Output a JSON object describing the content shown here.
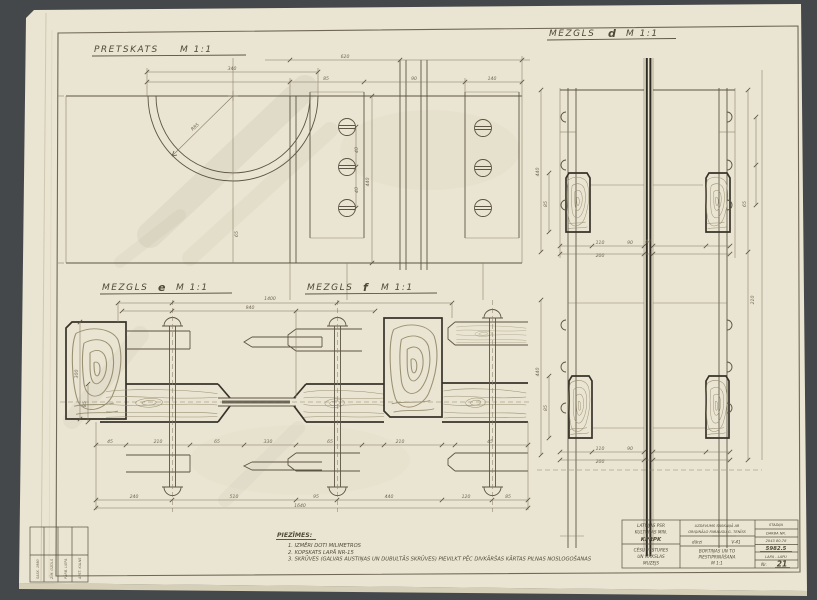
{
  "palette": {
    "bg": "#45484b",
    "paper": "#eae5d2",
    "paper_under": "#d6cfb8",
    "ink": "#4f4937",
    "heavy": "#38332a",
    "pencil": "#9a9072"
  },
  "labels": {
    "pretskats": {
      "name": "PRETSKATS",
      "scale": "M 1:1"
    },
    "d": {
      "name": "MEZGLS",
      "node": "d",
      "scale": "M 1:1"
    },
    "e": {
      "name": "MEZGLS",
      "node": "e",
      "scale": "M 1:1"
    },
    "f": {
      "name": "MEZGLS",
      "node": "f",
      "scale": "M 1:1"
    }
  },
  "notes": {
    "title": "PIEZĪMES:",
    "items": [
      "1.  IZMĒRI DOTI MILIMETROS",
      "2.  KOPSKATS LAPĀ NR-15",
      "3.  SKRŪVES (GALVAS AUSTIŅAS UN DUBULTĀS SKRŪVES) PIEVILKT PĒC DIVKĀRŠAS KĀRTAS PILNAS NOSLOGOŠANAS"
    ]
  },
  "title_block": {
    "org": [
      "LATVIJAS PSR",
      "KULTŪRAS MIN.",
      "KPRPK"
    ],
    "object": [
      "CĒSU VĒSTURES",
      "UN MĀKSLAS",
      "MUZEJS"
    ],
    "task": [
      "UZDEVUMS SASKAŅĀ AR",
      "ORIĢINĀLO PARAUGU G. TENĪSS"
    ],
    "stage_left": "dārzi",
    "stage_right": "V-41",
    "subject": [
      "BORTIŅAS UN TO",
      "PIESTIPRINĀŠANA",
      "M 1:1"
    ],
    "col3": [
      "STADIJA",
      "DARBA NR.",
      "2043 80-78",
      "5982.5",
      "LAPA - LAPU",
      "Nr."
    ],
    "sheet_no": "21"
  },
  "stamp": {
    "cols": [
      "SASK. 1980",
      "ZĪM. OZOLS",
      "PĀRB. LIEPA",
      "APST. KALNS"
    ]
  },
  "dims": [
    {
      "x": 232,
      "y": 70,
      "v": "340"
    },
    {
      "x": 345,
      "y": 58,
      "v": "620"
    },
    {
      "x": 326,
      "y": 80,
      "v": "85"
    },
    {
      "x": 414,
      "y": 80,
      "v": "90"
    },
    {
      "x": 492,
      "y": 80,
      "v": "140"
    },
    {
      "x": 196,
      "y": 128,
      "v": "R85",
      "r": -42
    },
    {
      "x": 238,
      "y": 234,
      "v": "65",
      "r": -90
    },
    {
      "x": 369,
      "y": 182,
      "v": "440",
      "r": -90
    },
    {
      "x": 358,
      "y": 150,
      "v": "40",
      "r": -90
    },
    {
      "x": 358,
      "y": 190,
      "v": "40",
      "r": -90
    },
    {
      "x": 600,
      "y": 244,
      "v": "110"
    },
    {
      "x": 630,
      "y": 244,
      "v": "90"
    },
    {
      "x": 600,
      "y": 257,
      "v": "200"
    },
    {
      "x": 648,
      "y": 243,
      "v": "44"
    },
    {
      "x": 547,
      "y": 204,
      "v": "85",
      "r": -90
    },
    {
      "x": 539,
      "y": 172,
      "v": "440",
      "r": -90
    },
    {
      "x": 746,
      "y": 204,
      "v": "65",
      "r": -90
    },
    {
      "x": 754,
      "y": 300,
      "v": "210",
      "r": -90
    },
    {
      "x": 600,
      "y": 450,
      "v": "110"
    },
    {
      "x": 630,
      "y": 450,
      "v": "90"
    },
    {
      "x": 600,
      "y": 463,
      "v": "200"
    },
    {
      "x": 547,
      "y": 408,
      "v": "85",
      "r": -90
    },
    {
      "x": 539,
      "y": 372,
      "v": "440",
      "r": -90
    },
    {
      "x": 270,
      "y": 300,
      "v": "1400"
    },
    {
      "x": 250,
      "y": 309,
      "v": "940"
    },
    {
      "x": 134,
      "y": 498,
      "v": "240"
    },
    {
      "x": 234,
      "y": 498,
      "v": "510"
    },
    {
      "x": 316,
      "y": 498,
      "v": "95"
    },
    {
      "x": 389,
      "y": 498,
      "v": "440"
    },
    {
      "x": 466,
      "y": 498,
      "v": "120"
    },
    {
      "x": 508,
      "y": 498,
      "v": "85"
    },
    {
      "x": 300,
      "y": 507,
      "v": "1640"
    },
    {
      "x": 110,
      "y": 443,
      "v": "45"
    },
    {
      "x": 158,
      "y": 443,
      "v": "210"
    },
    {
      "x": 217,
      "y": 443,
      "v": "65"
    },
    {
      "x": 268,
      "y": 443,
      "v": "330"
    },
    {
      "x": 330,
      "y": 443,
      "v": "65"
    },
    {
      "x": 400,
      "y": 443,
      "v": "210"
    },
    {
      "x": 490,
      "y": 443,
      "v": "45"
    },
    {
      "x": 86,
      "y": 404,
      "v": "85",
      "r": -90
    },
    {
      "x": 78,
      "y": 374,
      "v": "300",
      "r": -90
    }
  ]
}
